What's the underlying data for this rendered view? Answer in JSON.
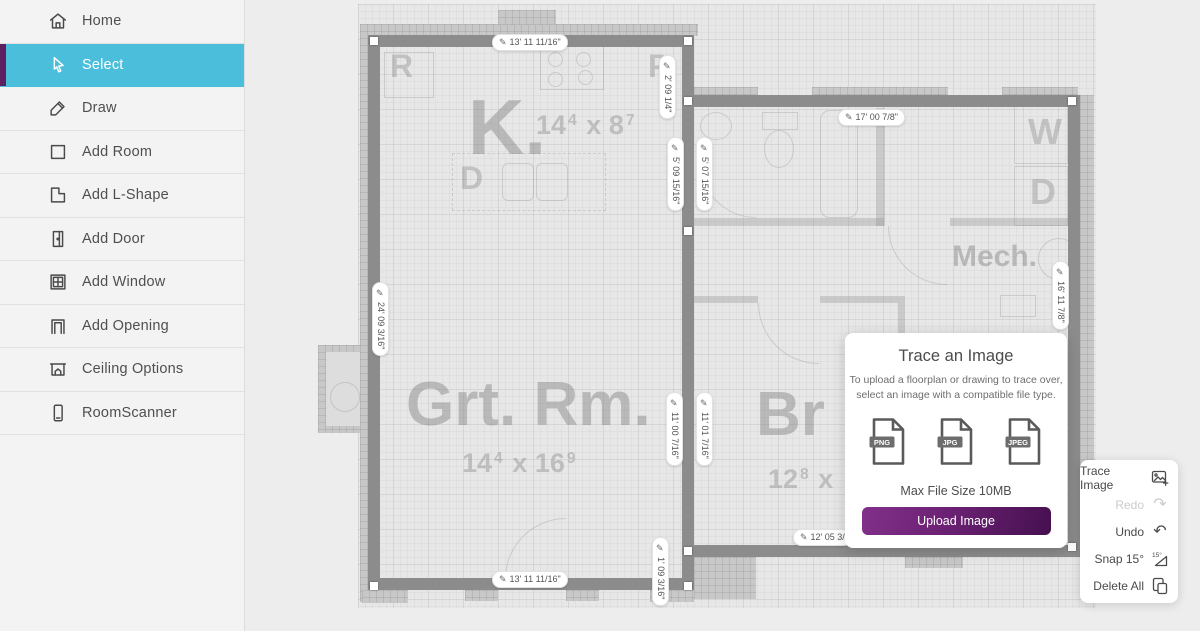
{
  "icons": {
    "pencil_edit": "✎",
    "undo": "↶",
    "redo": "↷"
  },
  "colors": {
    "accent_cyan": "#4abedb",
    "accent_purple_strip": "#5c2060",
    "upload_button_purple": "#6b2173",
    "wall_gray": "#8c8c8c"
  },
  "sidebar": {
    "items": [
      {
        "label": "Home"
      },
      {
        "label": "Select"
      },
      {
        "label": "Draw"
      },
      {
        "label": "Add Room"
      },
      {
        "label": "Add L-Shape"
      },
      {
        "label": "Add Door"
      },
      {
        "label": "Add Window"
      },
      {
        "label": "Add Opening"
      },
      {
        "label": "Ceiling Options"
      },
      {
        "label": "RoomScanner"
      }
    ]
  },
  "floorplan": {
    "dimensions": [
      {
        "id": "kitchen-top",
        "text": "13' 11 11/16\""
      },
      {
        "id": "kitchen-right-upper",
        "text": "2' 09 1/4\""
      },
      {
        "id": "kitchen-right-lower",
        "text": "5' 09 15/16\""
      },
      {
        "id": "bath-left",
        "text": "5' 07 15/16\""
      },
      {
        "id": "right-room-top",
        "text": "17' 00 7/8\""
      },
      {
        "id": "left-wall",
        "text": "24' 09 3/16\""
      },
      {
        "id": "right-wall",
        "text": "16' 11 7/8\""
      },
      {
        "id": "great-room-right",
        "text": "11' 00 7/16\""
      },
      {
        "id": "bedroom-left",
        "text": "11' 01 7/16\""
      },
      {
        "id": "step-wall",
        "text": "1' 09 3/16\""
      },
      {
        "id": "bedroom-bottom",
        "text": "12' 05 3/"
      },
      {
        "id": "great-room-bottom",
        "text": "13' 11 11/16\""
      }
    ],
    "rooms": [
      {
        "abbr": "K.",
        "w": "14",
        "w_sup": "4",
        "sep": "x",
        "h": "8",
        "h_sup": "7"
      },
      {
        "abbr": "Grt. Rm.",
        "w": "14",
        "w_sup": "4",
        "sep": "x",
        "h": "16",
        "h_sup": "9"
      },
      {
        "abbr": "Br",
        "w": "12",
        "w_sup": "8",
        "sep": "x",
        "h": "",
        "h_sup": ""
      },
      {
        "abbr": "Mech."
      }
    ],
    "appliances": [
      {
        "label": "R"
      },
      {
        "label": "P"
      },
      {
        "label": "D"
      },
      {
        "label": "W"
      },
      {
        "label": "D"
      }
    ]
  },
  "modal": {
    "title": "Trace an Image",
    "body_line1": "To upload a floorplan or drawing to trace over,",
    "body_line2": "select an image with a compatible file type.",
    "file_types": [
      "PNG",
      "JPG",
      "JPEG"
    ],
    "max_file": "Max File Size 10MB",
    "upload_label": "Upload Image"
  },
  "tool_panel": {
    "items": [
      {
        "label": "Trace Image"
      },
      {
        "label": "Redo"
      },
      {
        "label": "Undo"
      },
      {
        "label": "Snap 15°",
        "icon_text": "15°"
      },
      {
        "label": "Delete All"
      }
    ]
  }
}
